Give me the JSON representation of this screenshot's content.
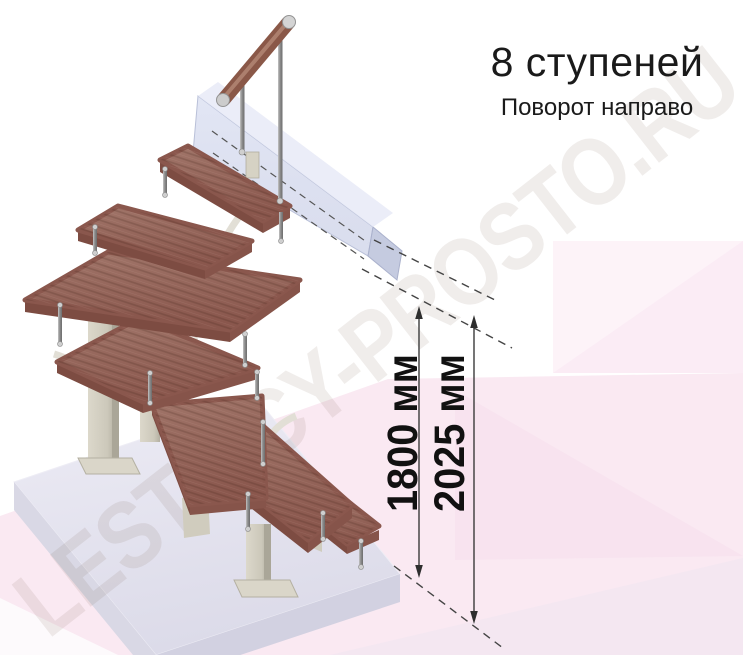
{
  "header": {
    "title": "8 ступеней",
    "subtitle": "Поворот направо"
  },
  "dimensions": {
    "height_to_landing": "1800 мм",
    "height_overall": "2025 мм"
  },
  "watermark": "LESTNICY-PROSTO.RU",
  "colors": {
    "wood": "#96655a",
    "wood_edge": "#7d4c42",
    "handrail_wood": "#8a5848",
    "support_post": "#d3cfc1",
    "baluster_steel": "#8f8f8f",
    "floor_slab": "#e7e6f1",
    "stringer_beam": "#d6dbee",
    "backdrop_pink": "#fae9f2",
    "dimension_ink": "#333333",
    "title_ink": "#1a1a1a"
  }
}
